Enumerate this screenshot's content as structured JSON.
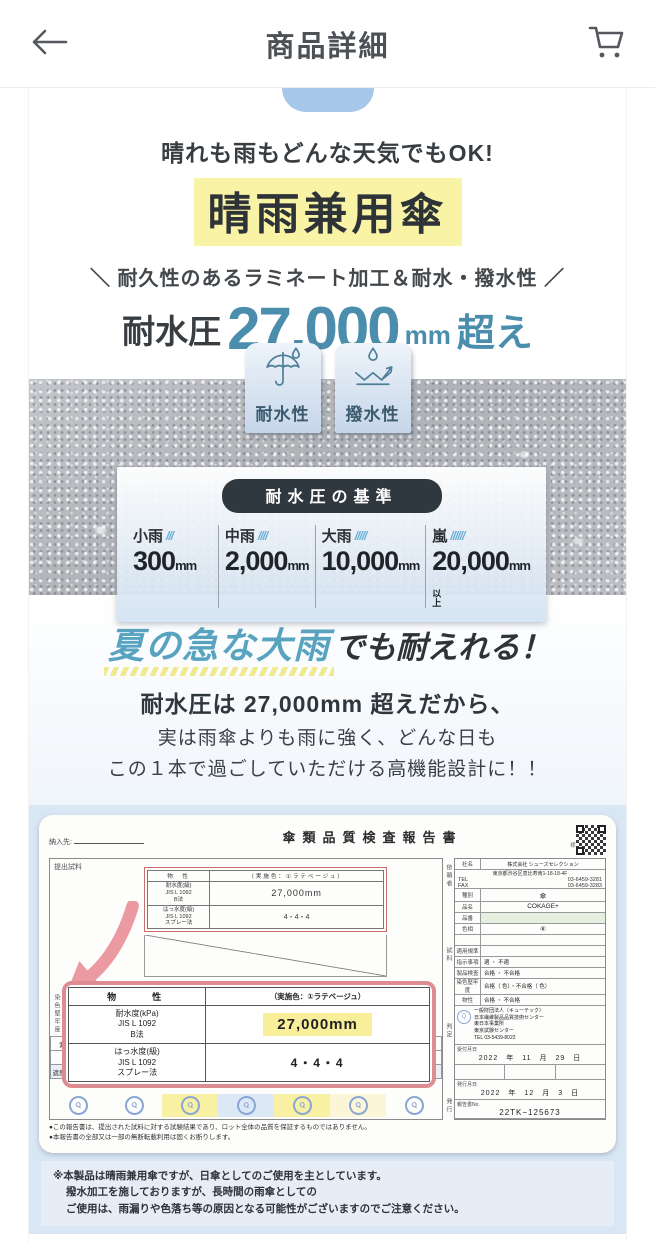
{
  "colors": {
    "accent_teal": "#4b8dac",
    "highlight_yellow": "#f8f3a5",
    "headline_blue": "#57a3c0",
    "doc_bg_blue": "#d9e6f3",
    "report_border_pink": "#dd8d92",
    "stamp_blue": "#8aa6d4",
    "pill_dark": "#30383f"
  },
  "icons": [
    "back-arrow-icon",
    "cart-icon",
    "umbrella-icon",
    "water-repel-icon",
    "qr-code",
    "stamp-icon",
    "arrow-curved-icon"
  ],
  "header": {
    "title": "商品詳細"
  },
  "hero": {
    "tagline": "晴れも雨もどんな天気でもOK!",
    "product_title": "晴雨兼用傘",
    "feature_line": "＼ 耐久性のあるラミネート加工＆耐水・撥水性 ／",
    "pressure_label": "耐水圧",
    "pressure_value": "27,000",
    "pressure_unit": "mm",
    "pressure_suffix": "超え"
  },
  "badges": [
    {
      "label": "耐水性"
    },
    {
      "label": "撥水性"
    }
  ],
  "standard": {
    "title": "耐水圧の基準",
    "levels": [
      {
        "label": "小雨",
        "marks": "///",
        "value": "300",
        "unit": "mm",
        "suffix": ""
      },
      {
        "label": "中雨",
        "marks": "////",
        "value": "2,000",
        "unit": "mm",
        "suffix": ""
      },
      {
        "label": "大雨",
        "marks": "/////",
        "value": "10,000",
        "unit": "mm",
        "suffix": ""
      },
      {
        "label": "嵐",
        "marks": "//////",
        "value": "20,000",
        "unit": "mm",
        "suffix": "以上"
      }
    ]
  },
  "summer": {
    "headline_accent": "夏の急な大雨",
    "headline_rest": "でも耐えれる！",
    "line1": "耐水圧は 27,000mm 超えだから、",
    "line2": "実は雨傘よりも雨に強く、どんな日も",
    "line3": "この１本で過ごしていただける高機能設計に！！"
  },
  "report": {
    "form_note": "様式110号改2",
    "title": "傘類品質検査報告書",
    "delivery_label": "納入先:",
    "sample_label": "提出試料",
    "fastness_label": "染色堅牢度",
    "stamp_text": "Q",
    "mini_table": {
      "header": "物　性",
      "header_note": "（実施色：①ラテベージュ）",
      "rows": [
        {
          "name": "耐水度(級)",
          "method": "JIS L 1092",
          "sub": "B法",
          "value": "27,000mm"
        },
        {
          "name": "はっ水度(級)",
          "method": "JIS L 1092",
          "sub": "スプレー法",
          "value": "4・4・4"
        }
      ]
    },
    "main_table": {
      "header": "物　　性",
      "header_note": "（実施色：①ラテベージュ）",
      "rows": [
        {
          "name": "耐水度(kPa)",
          "method": "JIS L 1092",
          "sub": "B法",
          "value": "27,000mm"
        },
        {
          "name": "はっ水度(級)",
          "method": "JIS L 1092",
          "sub": "スプレー法",
          "value": "4・4・4"
        }
      ]
    },
    "uv_row_labels": [
      "紫外線遮蔽率(%)",
      "遮光率(%)",
      "遮熱性(%) JIS L 1961"
    ],
    "uv_values": [
      "50+",
      "50+",
      "50+",
      "50+",
      "50+",
      "50+"
    ],
    "shade_values": [
      "100.00",
      "100.00",
      "100.00",
      "100.00",
      "100.00",
      "100.00"
    ],
    "footnotes": [
      "●この報告書は、提出された試料に対する試験結果であり、ロット全体の品質を保証するものではありません。",
      "●本報告書の全部又は一部の無断転載利用は固くお断りします。"
    ],
    "sidebar": {
      "group_labels": [
        "依頼者",
        "試料",
        "判定",
        "発行"
      ],
      "company_label": "社名",
      "company": "株式会社 シューズセレクション",
      "address_label": "所在地",
      "address": "東京都渋谷区恵比寿南1-18-18-4F",
      "tel_label": "TEL",
      "tel": "03-6459-3281",
      "fax_label": "FAX",
      "fax": "03-6459-3283",
      "kind_label": "種別",
      "kind": "傘",
      "product_label": "品名",
      "product": "COKAGE+",
      "code_label": "品番",
      "code": "",
      "color_label": "色相",
      "color": "⑥",
      "standard_label": "適用規準",
      "judgement": [
        {
          "label": "指示事項",
          "value": "適 ・ 不適"
        },
        {
          "label": "製品検査",
          "value": "合格 ・ 不合格"
        },
        {
          "label": "染色堅牢度",
          "value": "合格（ 色）・不合格（ 色）"
        },
        {
          "label": "物性",
          "value": "合格 ・ 不合格"
        }
      ],
      "agency_lines": [
        "一般財団法人（キューテック）",
        "日本繊維製品品質技術センター",
        "東日本事業所",
        "東京試験センター",
        "TEL 03-5439-8022"
      ],
      "received_label": "受付月日",
      "received": "2022　年　11　月　29　日",
      "issued_label": "発行月日",
      "issued": "2022　年　12　月　3　日",
      "report_no_label": "報告書No.",
      "report_no": "22TK−125673"
    }
  },
  "disclaimer": {
    "lines": [
      "※本製品は晴雨兼用傘ですが、日傘としてのご使用を主としています。",
      "撥水加工を施しておりますが、長時間の雨傘としての",
      "ご使用は、雨漏りや色落ち等の原因となる可能性がございますのでご注意ください。"
    ]
  }
}
